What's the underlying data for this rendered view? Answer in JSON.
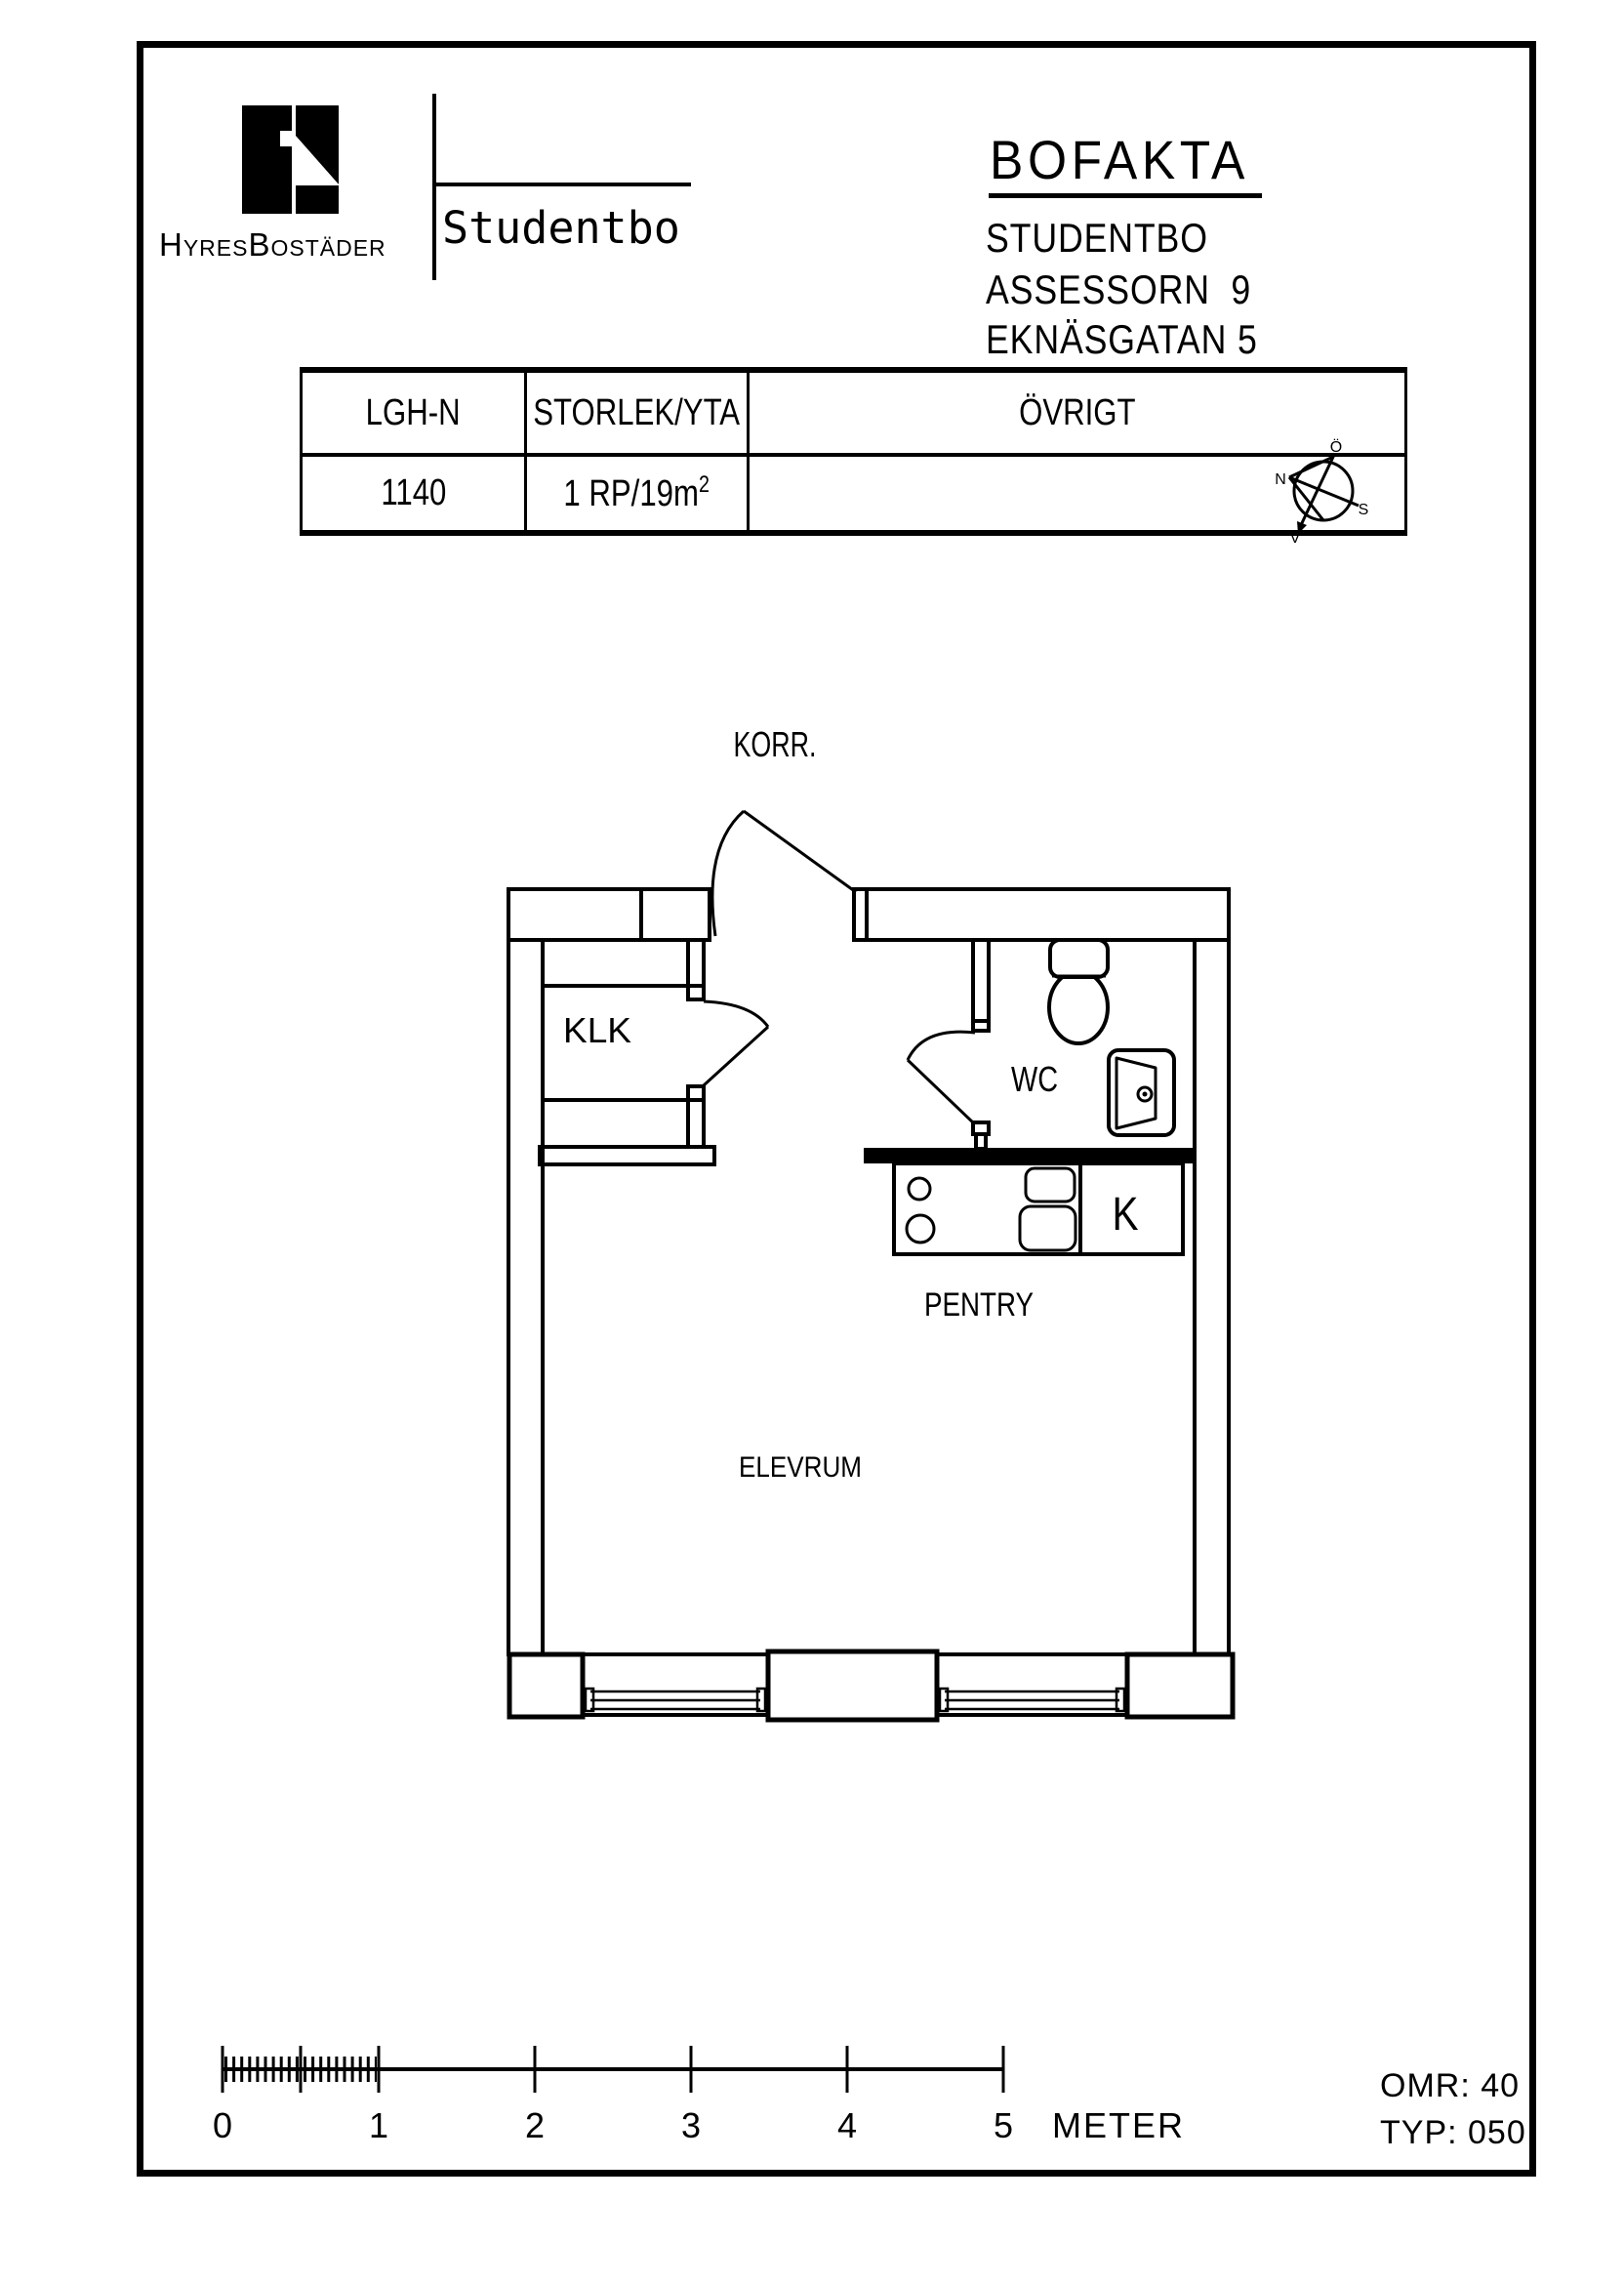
{
  "header": {
    "brand_name": "HyresBostäder",
    "brand_product": "Studentbo",
    "doc_title": "BOFAKTA",
    "project": "STUDENTBO",
    "property": "ASSESSORN  9",
    "address": "EKNÄSGATAN 5"
  },
  "info_table": {
    "col_apartment": "LGH-N",
    "col_size": "STORLEK/YTA",
    "col_other": "ÖVRIGT",
    "apartment_no": "1140",
    "size_value": "1 RP/19m",
    "size_sup": "2",
    "other_value": ""
  },
  "compass": {
    "north": "N",
    "south": "S",
    "east": "Ö",
    "west": "V"
  },
  "floorplan": {
    "corridor": "KORR.",
    "closet": "KLK",
    "wc": "WC",
    "kitchen": "K",
    "pantry": "PENTRY",
    "room": "ELEVRUM"
  },
  "scalebar": {
    "t0": "0",
    "t1": "1",
    "t2": "2",
    "t3": "3",
    "t4": "4",
    "t5": "5",
    "unit": "METER"
  },
  "footer": {
    "area": "OMR: 40",
    "type": "TYP: 050"
  },
  "colors": {
    "ink": "#000000",
    "paper": "#ffffff"
  }
}
